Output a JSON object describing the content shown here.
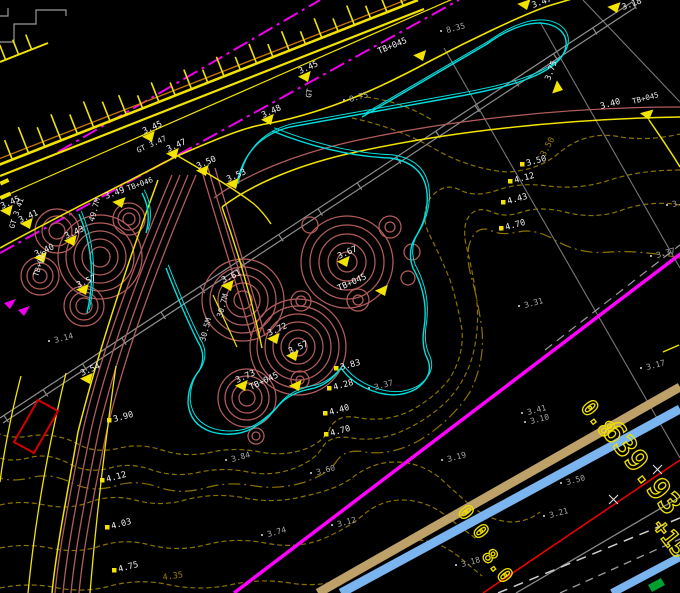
{
  "title": "CAD site plan viewport",
  "colors": {
    "background": "#000000",
    "road_yellow": "#f2e300",
    "edge_orange": "#c87800",
    "centerline_magenta": "#ef00ef",
    "utility_magenta": "#ff00ff",
    "curb_cyan": "#00dede",
    "planting_red": "#b25c5c",
    "contour_olive": "#8a7300",
    "survey_gray": "#8f8f8f",
    "label_white": "#ededed",
    "spot_gray": "#a8a8a8",
    "pipe_tan": "#bda169",
    "pipe_blue": "#7ab5ef",
    "line_red": "#e60000",
    "flag_green": "#00a030",
    "rect_red": "#d40000"
  },
  "elevation_markers": [
    {
      "x": 10,
      "y": 216,
      "l": "3.45",
      "r": -24,
      "ldx": -8,
      "ldy": -7,
      "sub": "GT 3.41",
      "sr": -72,
      "sdx": 4,
      "sdy": 13
    },
    {
      "x": 30,
      "y": 229,
      "l": "3.41",
      "r": -24,
      "ldx": -10,
      "ldy": -6
    },
    {
      "x": 74,
      "y": 246,
      "l": "3.43",
      "r": -24,
      "ldx": -8,
      "ldy": -7
    },
    {
      "x": 44,
      "y": 263,
      "l": "3.40",
      "r": -24,
      "ldx": -8,
      "ldy": -6,
      "sub": "TB+045",
      "sr": -72,
      "sdx": -6,
      "sdy": 14
    },
    {
      "x": 86,
      "y": 295,
      "l": "3.57",
      "r": -24,
      "ldx": -8,
      "ldy": -7
    },
    {
      "x": 122,
      "y": 208,
      "l": "3.49",
      "r": -20,
      "ldx": -16,
      "ldy": -9,
      "sub": "TB+046",
      "sr": -20,
      "sdx": 6,
      "sdy": -17
    },
    {
      "x": 152,
      "y": 142,
      "l": "3.45",
      "r": -24,
      "ldx": -8,
      "ldy": -8,
      "sub": "GT 3.47",
      "sr": -24,
      "sdx": -14,
      "sdy": 11
    },
    {
      "x": 176,
      "y": 159,
      "l": "3.47",
      "r": -24,
      "ldx": -8,
      "ldy": -7
    },
    {
      "x": 206,
      "y": 176,
      "l": "3.50",
      "r": -24,
      "ldx": -8,
      "ldy": -7
    },
    {
      "x": 236,
      "y": 189,
      "l": "3.53",
      "r": -24,
      "ldx": -8,
      "ldy": -7
    },
    {
      "x": 271,
      "y": 125,
      "l": "3.48",
      "r": -24,
      "ldx": -8,
      "ldy": -7
    },
    {
      "x": 308,
      "y": 82,
      "l": "3.45",
      "r": -24,
      "ldx": -8,
      "ldy": -8,
      "sub": "GT",
      "sr": -82,
      "sdx": 3,
      "sdy": 16
    },
    {
      "x": 423,
      "y": 61,
      "l": "TB+045",
      "r": -22,
      "ldx": -44,
      "ldy": -7
    },
    {
      "x": 527,
      "y": 10,
      "l": "3.47",
      "r": -20,
      "ldx": 6,
      "ldy": -2
    },
    {
      "x": 617,
      "y": 13,
      "l": "3.18",
      "r": -20,
      "ldx": 6,
      "ldy": -3
    },
    {
      "x": 563,
      "y": 90,
      "l": "3.75",
      "r": -70,
      "ldx": -13,
      "ldy": -9
    },
    {
      "x": 649,
      "y": 120,
      "l": "3.40",
      "r": -15,
      "ldx": -48,
      "ldy": -11,
      "sub": "TB+045",
      "sr": -15,
      "sdx": -16,
      "sdy": -16
    },
    {
      "x": 347,
      "y": 267,
      "l": "3.67",
      "r": -24,
      "ldx": -8,
      "ldy": -8
    },
    {
      "x": 231,
      "y": 291,
      "l": "3.61",
      "r": -24,
      "ldx": -8,
      "ldy": -8
    },
    {
      "x": 385,
      "y": 296,
      "l": "TB+045",
      "r": -24,
      "ldx": -46,
      "ldy": -5
    },
    {
      "x": 277,
      "y": 344,
      "l": "3.72",
      "r": -24,
      "ldx": -8,
      "ldy": -8
    },
    {
      "x": 296,
      "y": 361,
      "l": "3.57",
      "r": -24,
      "ldx": -6,
      "ldy": -7
    },
    {
      "x": 245,
      "y": 391,
      "l": "3.73",
      "r": -24,
      "ldx": -8,
      "ldy": -8
    },
    {
      "x": 299,
      "y": 391,
      "l": "TB+045",
      "r": -25,
      "ldx": -48,
      "ldy": -1
    },
    {
      "x": 90,
      "y": 384,
      "l": "3.54",
      "r": -24,
      "ldx": -8,
      "ldy": -8
    }
  ],
  "contour_labels": [
    {
      "x": 120,
      "y": 420,
      "l": "3.90"
    },
    {
      "x": 113,
      "y": 480,
      "l": "4.12"
    },
    {
      "x": 118,
      "y": 527,
      "l": "4.03"
    },
    {
      "x": 125,
      "y": 570,
      "l": "4.75"
    },
    {
      "x": 347,
      "y": 368,
      "l": "3.83"
    },
    {
      "x": 340,
      "y": 388,
      "l": "4.28"
    },
    {
      "x": 336,
      "y": 413,
      "l": "4.40"
    },
    {
      "x": 337,
      "y": 434,
      "l": "4.70"
    },
    {
      "x": 533,
      "y": 164,
      "l": "3.50"
    },
    {
      "x": 521,
      "y": 181,
      "l": "4.12"
    },
    {
      "x": 514,
      "y": 202,
      "l": "4.43"
    },
    {
      "x": 512,
      "y": 228,
      "l": "4.70"
    }
  ],
  "contour_inline_labels": [
    {
      "x": 545,
      "y": 157,
      "l": "3.50",
      "r": -62
    },
    {
      "x": 163,
      "y": 580,
      "l": "4.35",
      "r": -8
    }
  ],
  "spot_elevations": [
    {
      "x": 447,
      "y": 33,
      "l": "8.35"
    },
    {
      "x": 350,
      "y": 102,
      "l": "8.75"
    },
    {
      "x": 55,
      "y": 343,
      "l": "3.14"
    },
    {
      "x": 232,
      "y": 462,
      "l": "3.84"
    },
    {
      "x": 317,
      "y": 475,
      "l": "3.60"
    },
    {
      "x": 268,
      "y": 537,
      "l": "3.74"
    },
    {
      "x": 338,
      "y": 527,
      "l": "3.12"
    },
    {
      "x": 375,
      "y": 390,
      "l": "3.37"
    },
    {
      "x": 525,
      "y": 308,
      "l": "3.31"
    },
    {
      "x": 657,
      "y": 258,
      "l": "3.37"
    },
    {
      "x": 647,
      "y": 370,
      "l": "3.17"
    },
    {
      "x": 673,
      "y": 207,
      "l": "3.40"
    },
    {
      "x": 528,
      "y": 415,
      "l": "3.41"
    },
    {
      "x": 531,
      "y": 424,
      "l": "3.10"
    },
    {
      "x": 448,
      "y": 462,
      "l": "3.19"
    },
    {
      "x": 550,
      "y": 518,
      "l": "3.21"
    },
    {
      "x": 567,
      "y": 485,
      "l": "3.50"
    },
    {
      "x": 462,
      "y": 567,
      "l": "3.18"
    }
  ],
  "pipe_labels": [
    {
      "x": 94,
      "y": 222,
      "l": "49.7M"
    },
    {
      "x": 222,
      "y": 318,
      "l": "30.7M"
    },
    {
      "x": 205,
      "y": 342,
      "l": "30.5M"
    }
  ],
  "station_texts": [
    {
      "x": 592,
      "y": 423,
      "r": 52,
      "s": 22,
      "l": "0.8"
    },
    {
      "x": 634,
      "y": 474,
      "r": 52,
      "s": 30,
      "l": "639.93"
    },
    {
      "x": 468,
      "y": 526,
      "r": 52,
      "s": 20,
      "l": "0 0"
    },
    {
      "x": 492,
      "y": 570,
      "r": 52,
      "s": 20,
      "l": "8.0"
    },
    {
      "x": 664,
      "y": 543,
      "r": 52,
      "s": 23,
      "l": "+15"
    }
  ]
}
